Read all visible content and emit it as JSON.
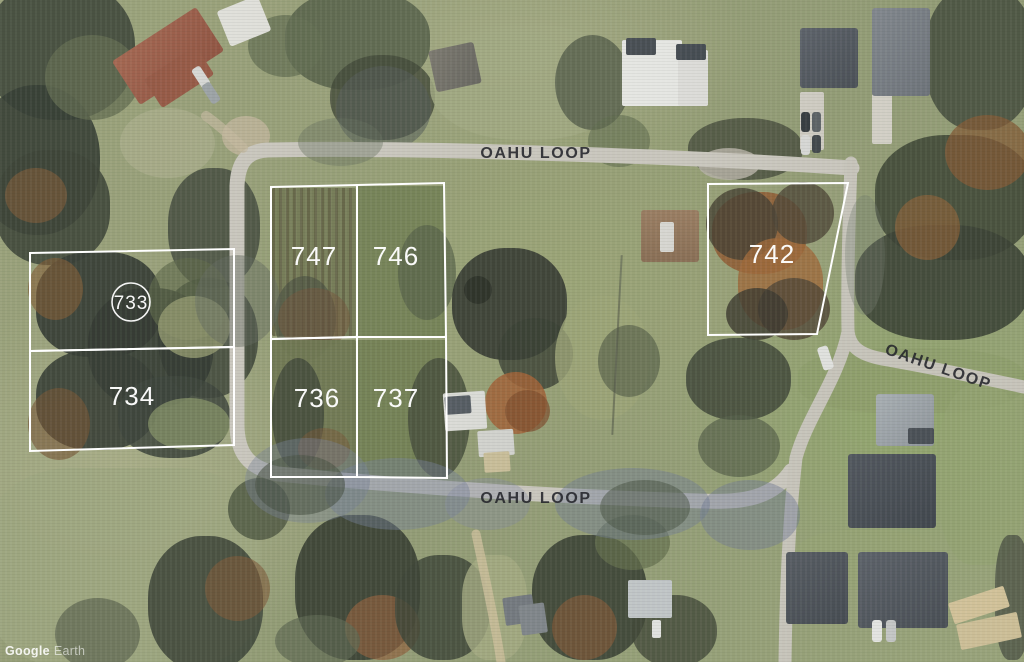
{
  "map": {
    "lots": [
      {
        "number": "733"
      },
      {
        "number": "734"
      },
      {
        "number": "747"
      },
      {
        "number": "746"
      },
      {
        "number": "736"
      },
      {
        "number": "737"
      },
      {
        "number": "742"
      }
    ],
    "streets": {
      "top": "OAHU LOOP",
      "right": "OAHU LOOP",
      "bottom": "OAHU LOOP"
    },
    "watermark": {
      "brand": "Google",
      "product": "Earth"
    },
    "colors": {
      "lot_outline": "#ffffff",
      "lot_label": "#ffffff",
      "street_text": "#24252b",
      "road": "#cac6bd"
    }
  }
}
